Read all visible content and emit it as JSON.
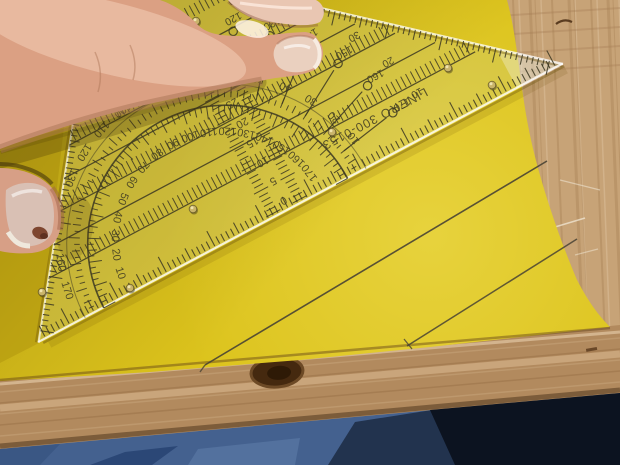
{
  "ruler": {
    "brand": "LINERO 300-0153",
    "protractor": {
      "inner_numbers": [
        "10",
        "20",
        "30",
        "40",
        "50",
        "60",
        "70",
        "80",
        "90",
        "100",
        "110",
        "120",
        "130",
        "140",
        "150",
        "160",
        "170"
      ],
      "outer_numbers": [
        "170",
        "160",
        "150",
        "140",
        "130",
        "120",
        "110",
        "100",
        "90",
        "80",
        "70",
        "60",
        "50",
        "40",
        "30",
        "20",
        "10"
      ]
    },
    "altitude_scale_numbers": [
      "0",
      "5",
      "10",
      "15",
      "20",
      "25",
      "30",
      "35"
    ],
    "angle_pairs": [
      [
        "60",
        "120"
      ],
      [
        "50",
        "130"
      ],
      [
        "40",
        "140"
      ],
      [
        "30",
        "150"
      ],
      [
        "20",
        "160"
      ],
      [
        "10",
        "170"
      ]
    ]
  },
  "colors": {
    "paper": "#dcc31c",
    "paper_shadow": "#a9920d",
    "marking": "#3c3822",
    "wood": "#c7a377",
    "wood_grain_dark": "#a87f55",
    "wood_grain_light": "#e0c49c",
    "wood_edge": "#b28a5e",
    "wood_knot": "#45290f",
    "denim": "#44618f",
    "denim_fold": "#2b4776",
    "denim_light": "#53719e",
    "denim_dark": "#0c1320",
    "skin": "#dba083",
    "skin_light": "#f6d2bc",
    "skin_shadow": "#b97f63",
    "nail": "#ead0bf",
    "thumb_nail": "#d9c0b4",
    "pencil": "#484234",
    "ink_bump": "#c9b46a",
    "plastic_edge": "#ffffff"
  }
}
